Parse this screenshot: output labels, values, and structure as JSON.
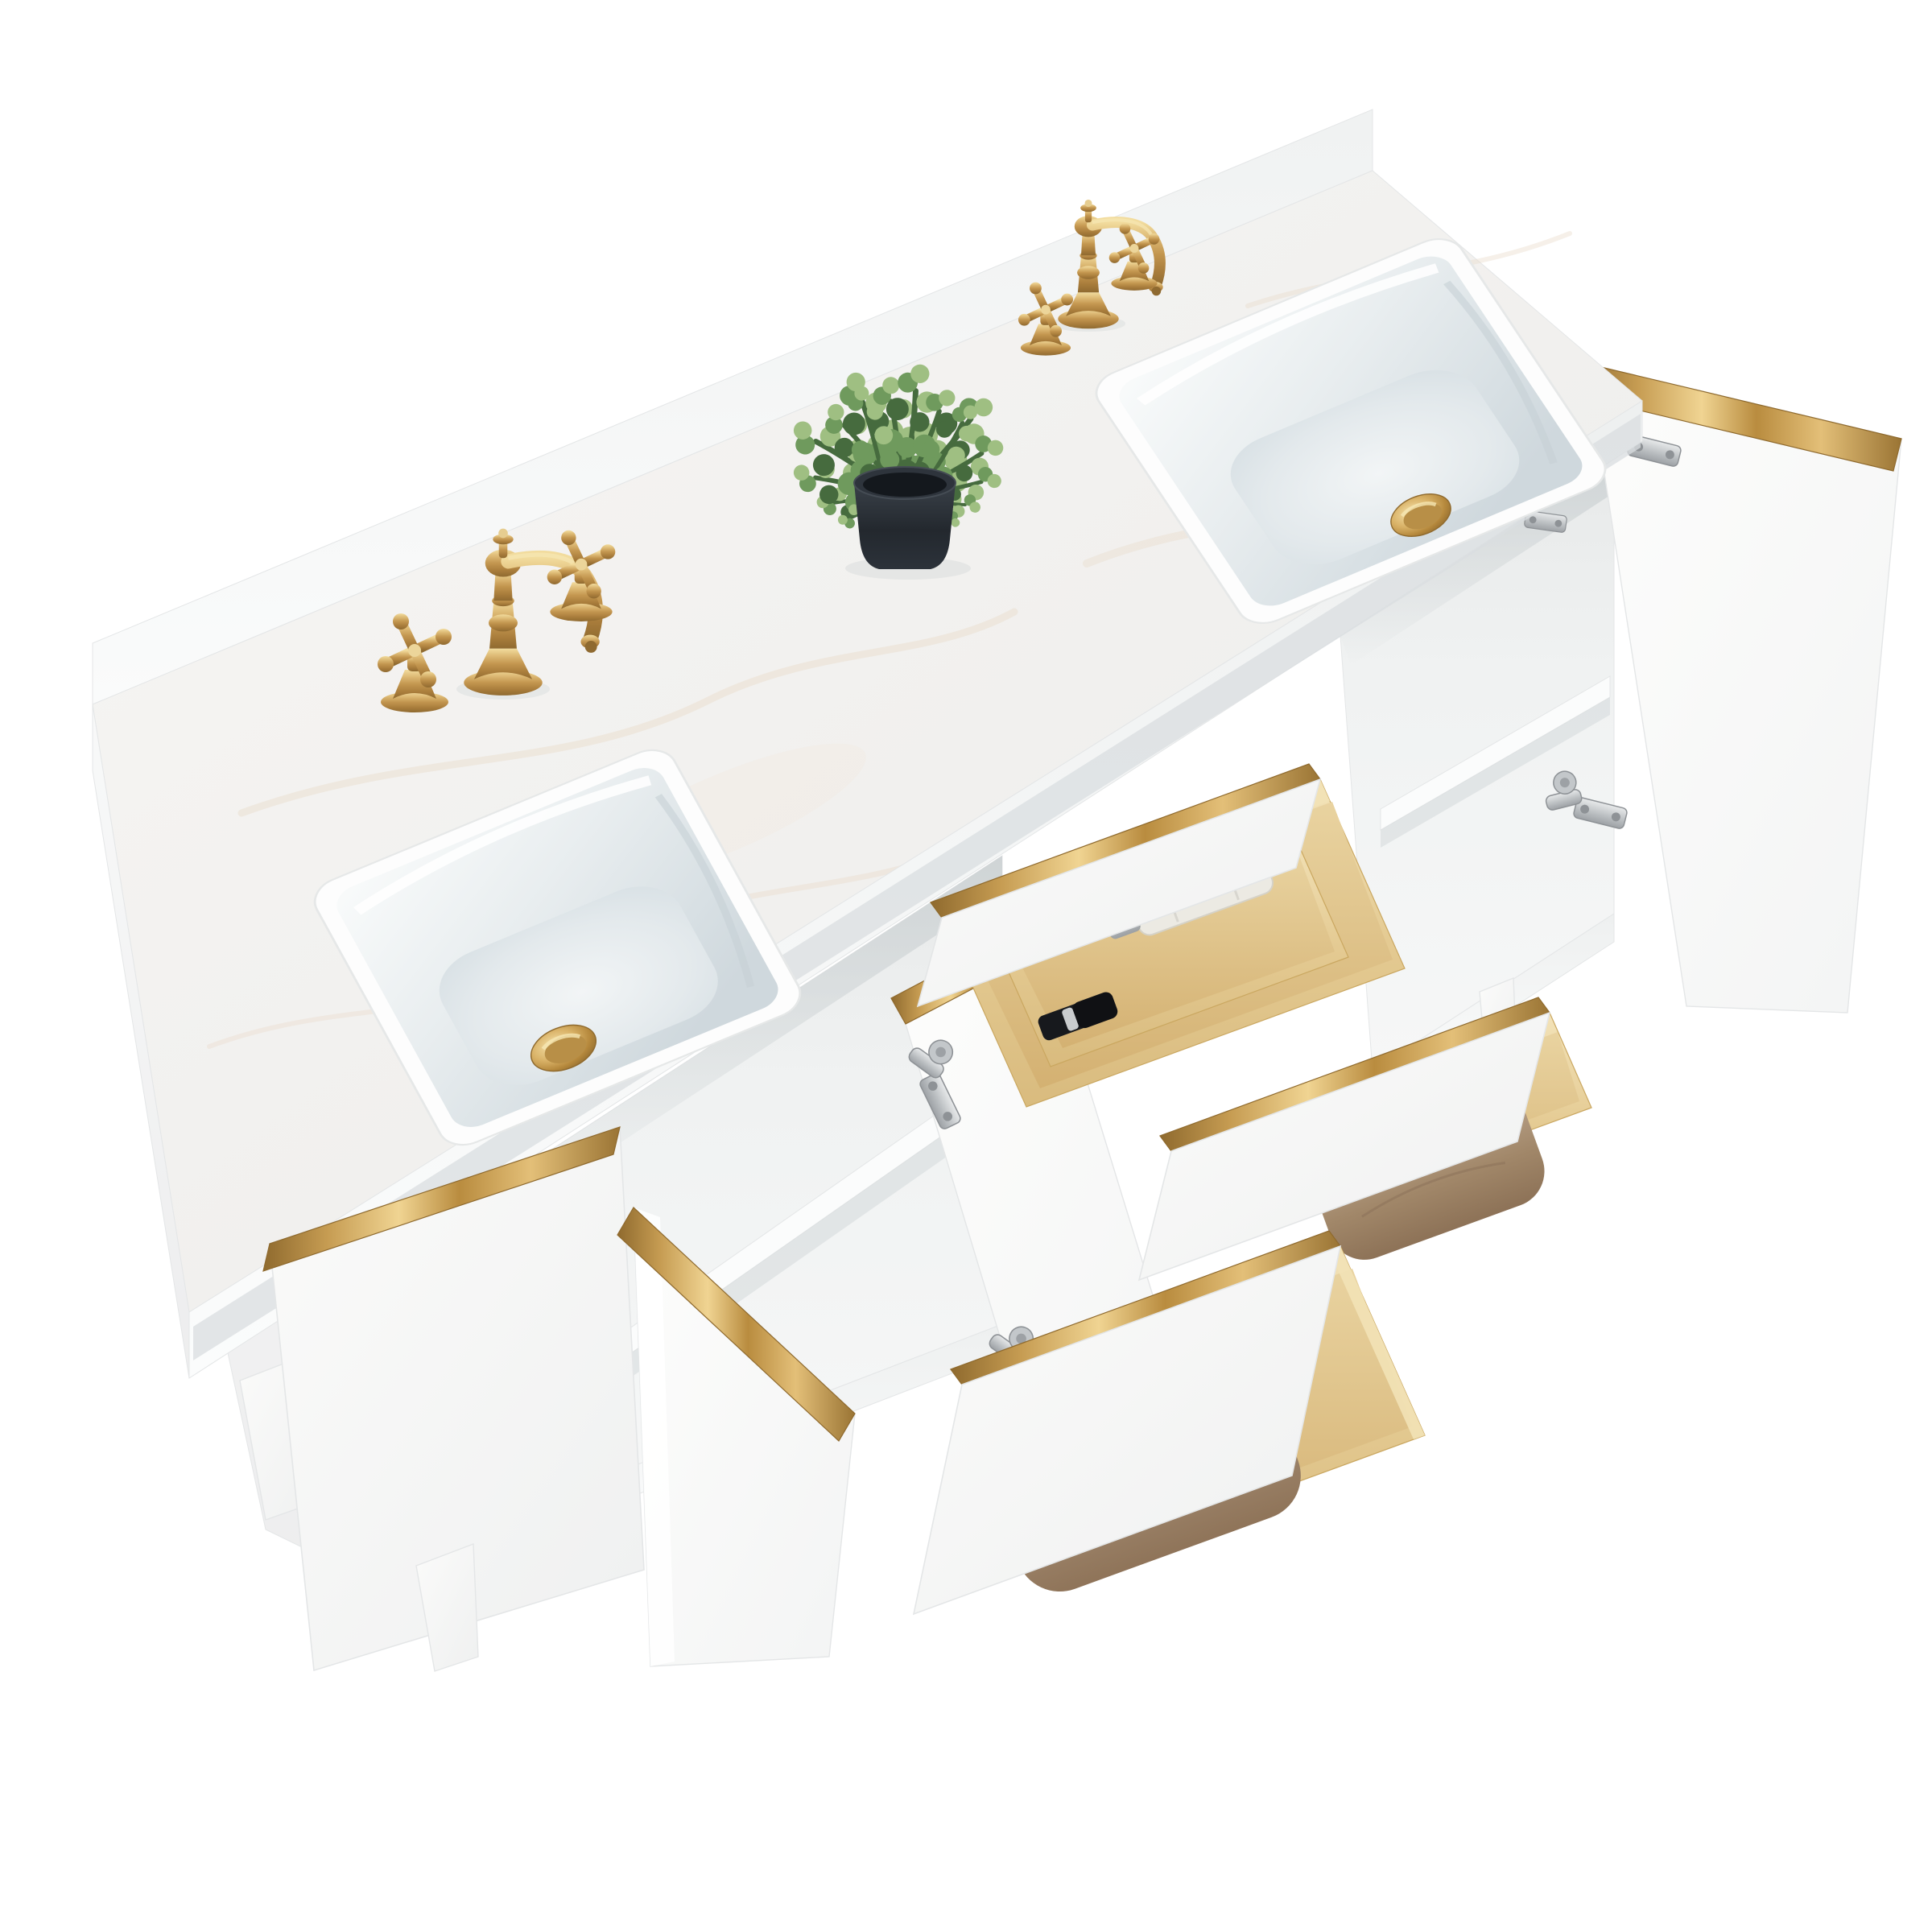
{
  "scene": {
    "type": "product-photo",
    "subject": "White double-sink bathroom vanity, three-quarter top view, open doors and drawers",
    "background": "#ffffff"
  },
  "colors": {
    "background": "#ffffff",
    "gold": "#c3964f",
    "gold-light": "#f0d492",
    "gold-dark": "#8f6a2e",
    "marble": "#f3f2f0",
    "marble-vein": "#e9dccb",
    "porcelain": "#fbfcfc",
    "bowl-shadow": "#d6dee2",
    "cabinet": "#f7f8f8",
    "cabinet-edge": "#e4e6e7",
    "interior": "#eff1f1",
    "wood": "#e6cc95",
    "wood-dark": "#d8b97c",
    "towel": "#a98f74",
    "towel-light": "#c2ac95",
    "plant": "#6f9a5d",
    "plant-dark": "#466b3e",
    "plant-light": "#9fbf82",
    "pot": "#23282e",
    "hinge": "#b9bdc0",
    "shadow": "#d3d8da"
  },
  "objects": {
    "countertop": "White engineered-marble countertop with backsplash",
    "left_sink": "Left undermount rectangular ceramic sink",
    "right_sink": "Right undermount rectangular ceramic sink",
    "left_faucet": "Brushed-gold widespread faucet with two cross handles",
    "right_faucet": "Brushed-gold widespread faucet with two cross handles",
    "left_drain": "Gold pop-up drain",
    "right_drain": "Gold pop-up drain",
    "plant": "Faux eucalyptus plant in dark pot",
    "far_left_door": "Open left cabinet door with gold edge trim",
    "center_left_door": "Open center-left cabinet door with gold edge trim",
    "center_door": "Open center cabinet door with concealed hinges",
    "right_door": "Open right cabinet door with gold edge trim",
    "left_shelf": "Adjustable shelf in left cabinet",
    "right_shelf": "Adjustable shelf in right cabinet",
    "top_drawer": "Open top drawer with pine organizer tray, perfume bottle and lipstick",
    "middle_drawer": "Open middle drawer with folded towel",
    "bottom_drawer": "Open bottom drawer with folded towel",
    "legs": "Tapered square wood legs",
    "hinges": "Soft-close concealed nickel hinges"
  },
  "counts": {
    "sinks": 2,
    "faucets": 2,
    "doors": 4,
    "drawers": 3,
    "towels": 2,
    "legs": 3
  }
}
